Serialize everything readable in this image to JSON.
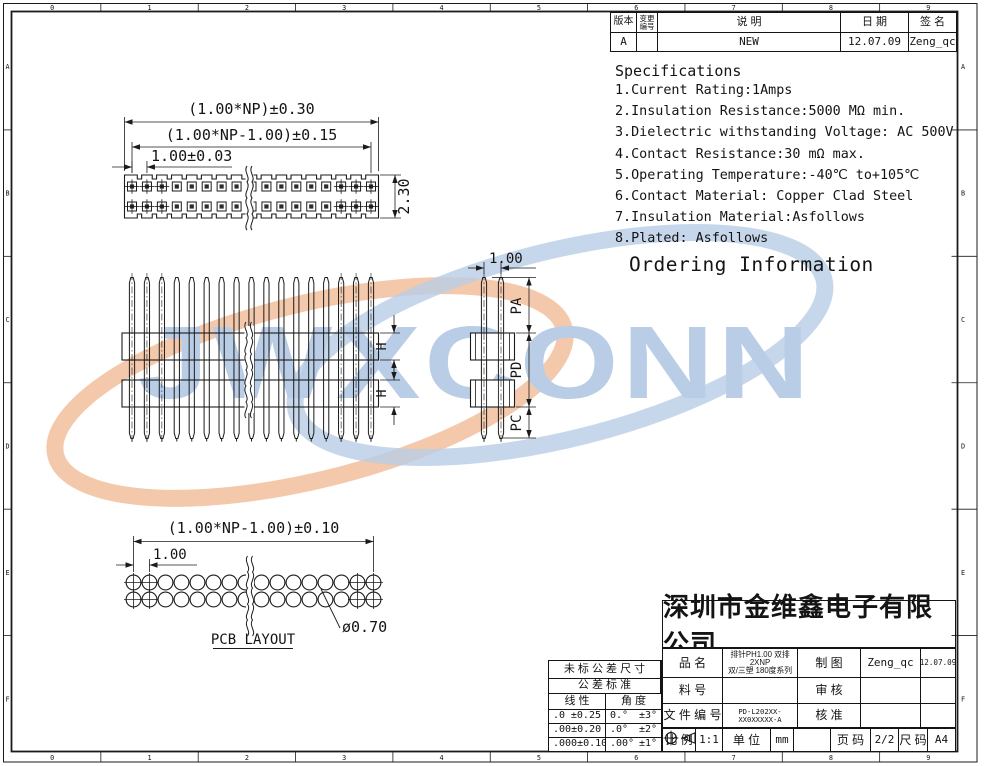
{
  "sheet": {
    "ruler_numbers": [
      "0",
      "1",
      "2",
      "3",
      "4",
      "5",
      "6",
      "7",
      "8",
      "9"
    ],
    "ruler_letters": [
      "A",
      "B",
      "C",
      "D",
      "E",
      "F"
    ]
  },
  "revision_table": {
    "headers": {
      "version": "版本",
      "change_no": "变更\n编号",
      "description": "说     明",
      "date": "日 期",
      "signature": "签 名"
    },
    "rows": [
      {
        "version": "A",
        "change_no": "",
        "description": "NEW",
        "date": "12.07.09",
        "signature": "Zeng_qc"
      }
    ]
  },
  "specifications": {
    "title": "Specifications",
    "lines": [
      "1.Current Rating:1Amps",
      "2.Insulation Resistance:5000 MΩ min.",
      "3.Dielectric withstanding Voltage: AC 500V",
      "4.Contact Resistance:30 mΩ max.",
      "5.Operating Temperature:-40℃ to+105℃",
      "6.Contact Material: Copper Clad Steel",
      "7.Insulation Material:Asfollows",
      "8.Plated: Asfollows"
    ],
    "ordering_title": "Ordering Information"
  },
  "drawing": {
    "watermark": "JWXCONN",
    "watermark_blue": "#b9cde6",
    "watermark_orange": "#f2c09c",
    "top_view": {
      "pin_count": 17,
      "pin_rows": 2,
      "hatched_end_pins": 3,
      "dim_overall": "(1.00*NP)±0.30",
      "dim_inner": "(1.00*NP-1.00)±0.15",
      "dim_pitch": "1.00±0.03",
      "dim_height": "2.30"
    },
    "front_view": {
      "pin_count": 17,
      "insulator_count": 2,
      "dim_h": "H"
    },
    "side_view": {
      "pin_count": 2,
      "dim_pitch": "1.00",
      "dim_pa": "PA",
      "dim_pd": "PD",
      "dim_pc": "PC"
    },
    "pcb_layout": {
      "title": "PCB LAYOUT",
      "hole_count": 16,
      "hole_rows": 2,
      "dim_span": "(1.00*NP-1.00)±0.10",
      "dim_pitch": "1.00",
      "dim_hole": "ø0.70"
    }
  },
  "tolerance_table": {
    "title1": "未 标 公 差 尺 寸",
    "title2": "公 差 标 准",
    "col_linear": "线 性",
    "col_angle": "角 度",
    "rows": [
      {
        "linear": ".0",
        "linear_tol": "±0.25",
        "angle": "0.°",
        "angle_tol": "±3°"
      },
      {
        "linear": ".00",
        "linear_tol": "±0.20",
        "angle": ".0°",
        "angle_tol": "±2°"
      },
      {
        "linear": ".000",
        "linear_tol": "±0.10",
        "angle": ".00°",
        "angle_tol": "±1°"
      }
    ]
  },
  "title_block": {
    "company": "深圳市金维鑫电子有限公司",
    "part_name_label": "品        名",
    "part_name": "排针PH1.00 双排 2XNP\n双/三塑 180度系列",
    "part_no_label": "料        号",
    "part_no": "",
    "file_no_label": "文 件 编 号",
    "file_no": "PD-L202XX-XX0XXXXX-A",
    "draw_label": "制        图",
    "draw_by": "Zeng_qc",
    "draw_date": "12.07.09",
    "check_label": "审        核",
    "check_by": "",
    "approve_label": "核        准",
    "approve_by": "",
    "scale_label": "比 例",
    "scale": "1:1",
    "unit_label": "单 位",
    "unit": "mm",
    "page_label": "页 码",
    "page": "2/2",
    "size_label": "尺 码",
    "size": "A4"
  }
}
